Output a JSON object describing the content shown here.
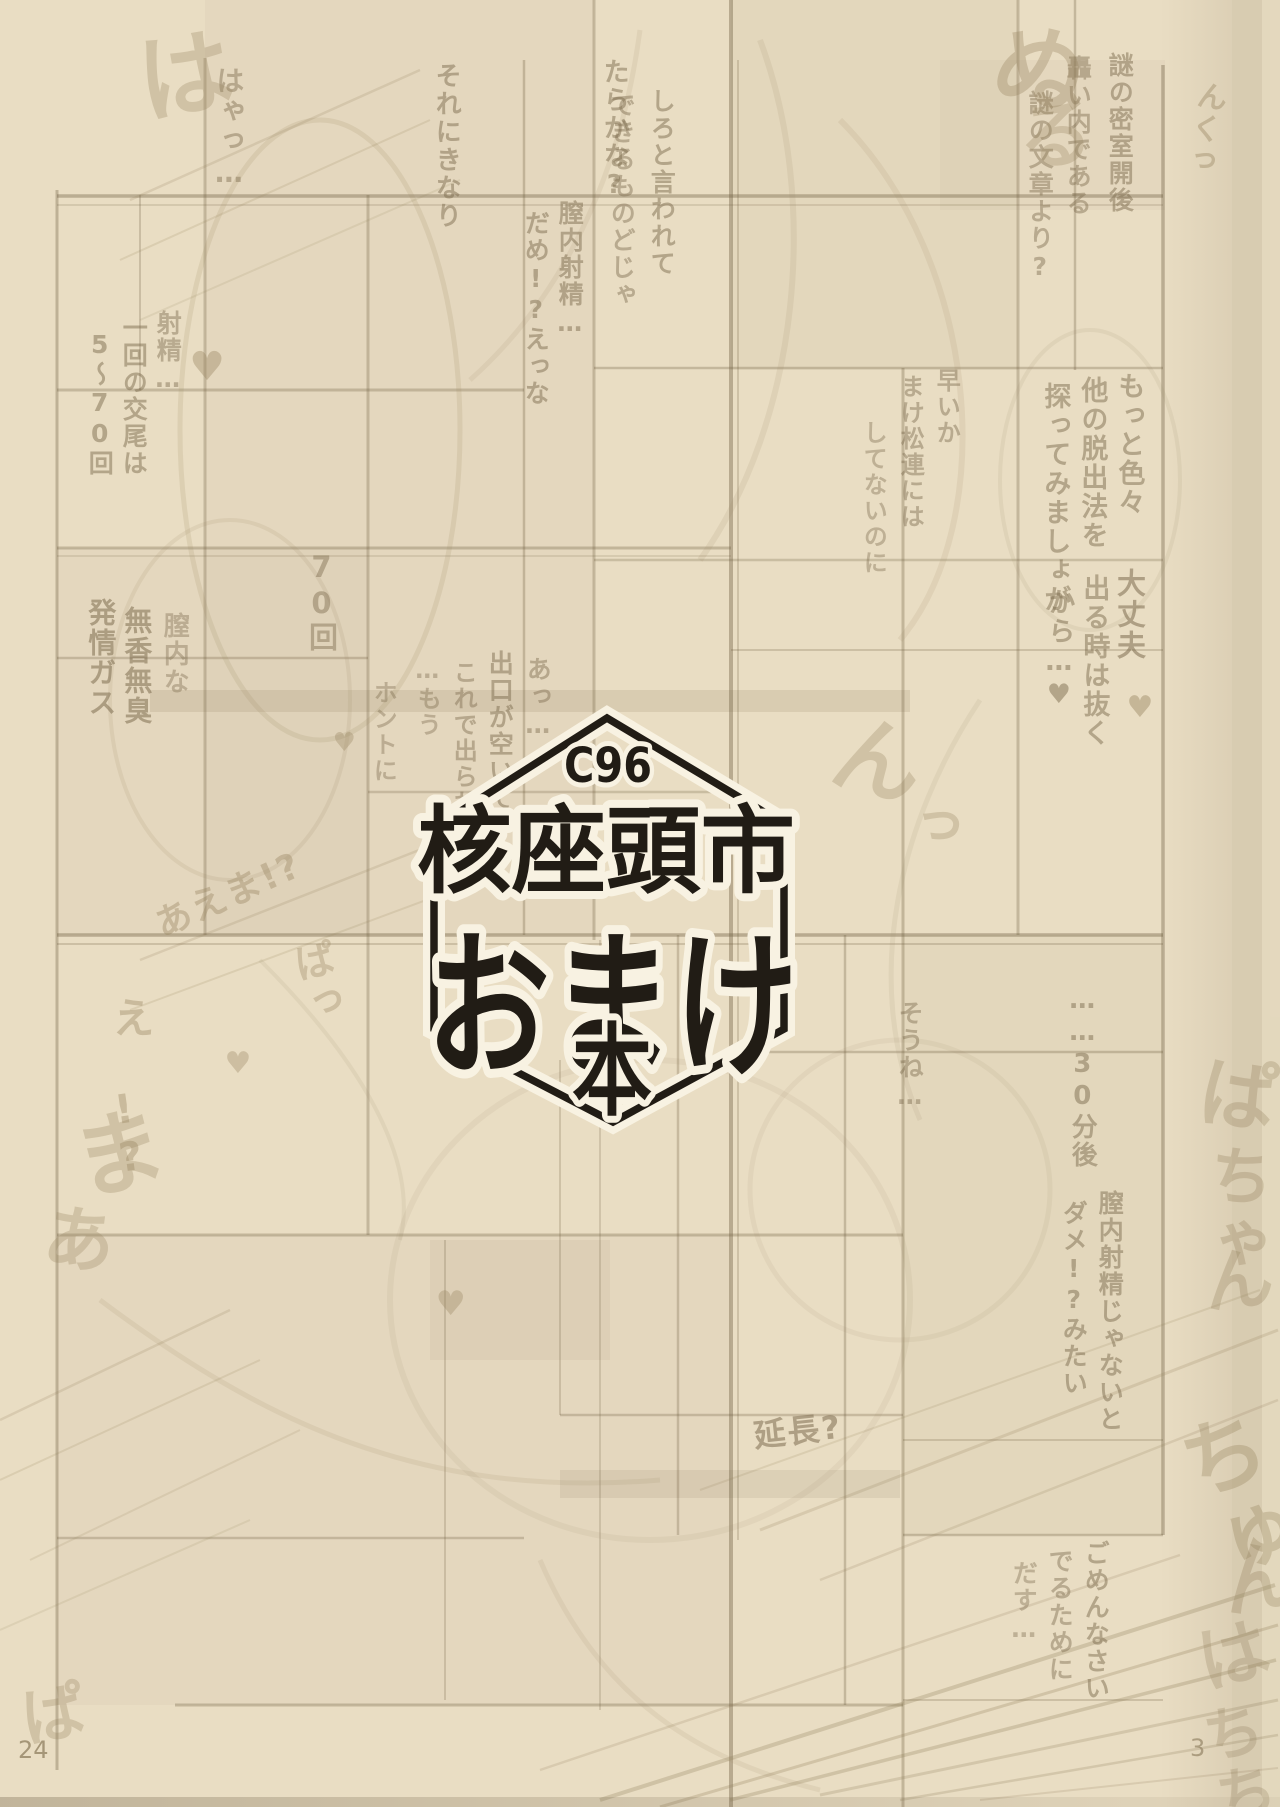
{
  "page": {
    "left_page_number": "24",
    "right_page_number": "3"
  },
  "logo": {
    "event_code": "C96",
    "title_kanji": "核座頭市",
    "title_kana": "おまけ",
    "title_suffix": "本"
  },
  "colors": {
    "paper": "#e9ddc3",
    "logo_ink": "#211c15",
    "logo_halo": "#f8f2e2",
    "bleed_ink": "#7f6e51",
    "sfx_ink": "#9a8763"
  },
  "bleedthrough": {
    "snippets": [
      {
        "text": "それにきなり",
        "x": 432,
        "y": 62,
        "size": 26,
        "o": 0.5
      },
      {
        "text": "たらかな?",
        "x": 600,
        "y": 58,
        "size": 26,
        "o": 0.5
      },
      {
        "text": "しろと言われて",
        "x": 648,
        "y": 88,
        "size": 25,
        "o": 0.5
      },
      {
        "text": "できるものどじゃ",
        "x": 608,
        "y": 92,
        "size": 25,
        "o": 0.45
      },
      {
        "text": "膣内射精…",
        "x": 556,
        "y": 200,
        "size": 25,
        "o": 0.5
      },
      {
        "text": "だめ!?えっな",
        "x": 522,
        "y": 210,
        "size": 25,
        "o": 0.5
      },
      {
        "text": "はゃっ…",
        "x": 214,
        "y": 66,
        "size": 28,
        "o": 0.45
      },
      {
        "text": "謎の密室開後",
        "x": 1106,
        "y": 52,
        "size": 25,
        "o": 0.5
      },
      {
        "text": "轟い内である",
        "x": 1064,
        "y": 55,
        "size": 25,
        "o": 0.45
      },
      {
        "text": "謎の文章より?",
        "x": 1026,
        "y": 90,
        "size": 25,
        "o": 0.45
      },
      {
        "text": "もっと色々",
        "x": 1114,
        "y": 372,
        "size": 27,
        "o": 0.5
      },
      {
        "text": "他の脱出法を",
        "x": 1077,
        "y": 376,
        "size": 27,
        "o": 0.5
      },
      {
        "text": "探ってみましょが",
        "x": 1040,
        "y": 382,
        "size": 27,
        "o": 0.5
      },
      {
        "text": "早いか",
        "x": 933,
        "y": 368,
        "size": 24,
        "o": 0.45
      },
      {
        "text": "まけ松連には",
        "x": 897,
        "y": 374,
        "size": 24,
        "o": 0.45
      },
      {
        "text": "してないのに",
        "x": 860,
        "y": 420,
        "size": 24,
        "o": 0.4
      },
      {
        "text": "大丈夫",
        "x": 1114,
        "y": 568,
        "size": 29,
        "o": 0.55
      },
      {
        "text": "出る時は抜く",
        "x": 1079,
        "y": 574,
        "size": 27,
        "o": 0.5
      },
      {
        "text": "から…♥",
        "x": 1044,
        "y": 588,
        "size": 27,
        "o": 0.5
      },
      {
        "text": "あっ…",
        "x": 524,
        "y": 656,
        "size": 25,
        "o": 0.45
      },
      {
        "text": "出口が空いて",
        "x": 486,
        "y": 650,
        "size": 25,
        "o": 0.5
      },
      {
        "text": "これで出られ",
        "x": 450,
        "y": 660,
        "size": 24,
        "o": 0.45
      },
      {
        "text": "…もう",
        "x": 414,
        "y": 656,
        "size": 24,
        "o": 0.4
      },
      {
        "text": "ホントに",
        "x": 370,
        "y": 680,
        "size": 24,
        "o": 0.4
      },
      {
        "text": "一回の交尾は",
        "x": 120,
        "y": 315,
        "size": 25,
        "o": 0.5
      },
      {
        "text": "5〜70回",
        "x": 86,
        "y": 330,
        "size": 25,
        "o": 0.5
      },
      {
        "text": "射精…",
        "x": 154,
        "y": 310,
        "size": 25,
        "o": 0.45
      },
      {
        "text": "70回",
        "x": 306,
        "y": 550,
        "size": 29,
        "o": 0.45
      },
      {
        "text": "発情ガス",
        "x": 86,
        "y": 598,
        "size": 28,
        "o": 0.55
      },
      {
        "text": "無香無臭",
        "x": 122,
        "y": 606,
        "size": 28,
        "o": 0.55
      },
      {
        "text": "膣内な",
        "x": 160,
        "y": 612,
        "size": 26,
        "o": 0.4
      },
      {
        "text": "そうね…",
        "x": 896,
        "y": 1000,
        "size": 25,
        "o": 0.45
      },
      {
        "text": "……30分後",
        "x": 1068,
        "y": 985,
        "size": 26,
        "o": 0.5
      },
      {
        "text": "膣内射精じゃないと",
        "x": 1096,
        "y": 1190,
        "size": 25,
        "o": 0.5
      },
      {
        "text": "ダメ!?みたい",
        "x": 1060,
        "y": 1200,
        "size": 25,
        "o": 0.5
      },
      {
        "text": "ごめんなさい",
        "x": 1082,
        "y": 1540,
        "size": 25,
        "o": 0.5
      },
      {
        "text": "でるために",
        "x": 1046,
        "y": 1548,
        "size": 25,
        "o": 0.45
      },
      {
        "text": "だす…",
        "x": 1010,
        "y": 1560,
        "size": 25,
        "o": 0.4
      },
      {
        "text": "延長?",
        "x": 752,
        "y": 1420,
        "size": 32,
        "rot": -6,
        "o": 0.55,
        "dir": "h"
      }
    ],
    "sfx": [
      {
        "text": "ぬ",
        "x": 994,
        "y": 8,
        "size": 95,
        "rot": 12,
        "o": 0.35
      },
      {
        "text": "る",
        "x": 1006,
        "y": 100,
        "size": 75,
        "rot": -5,
        "o": 0.3
      },
      {
        "text": "んくっ",
        "x": 1196,
        "y": 78,
        "size": 30,
        "rot": 10,
        "o": 0.4
      },
      {
        "text": "は",
        "x": 118,
        "y": 36,
        "size": 96,
        "rot": -10,
        "o": 0.3
      },
      {
        "text": "ん",
        "x": 836,
        "y": 700,
        "size": 90,
        "rot": 15,
        "o": 0.3
      },
      {
        "text": "っ",
        "x": 905,
        "y": 790,
        "size": 55,
        "rot": 10,
        "o": 0.3
      },
      {
        "text": "あえま!?",
        "x": 150,
        "y": 910,
        "size": 36,
        "rot": -24,
        "o": 0.4,
        "dir": "h"
      },
      {
        "text": "ぱっ",
        "x": 286,
        "y": 946,
        "size": 40,
        "rot": -12,
        "o": 0.35
      },
      {
        "text": "え",
        "x": 108,
        "y": 996,
        "size": 42,
        "o": 0.4
      },
      {
        "text": "!?",
        "x": 100,
        "y": 1090,
        "size": 40,
        "rot": -8,
        "o": 0.4
      },
      {
        "text": "ま",
        "x": 52,
        "y": 1120,
        "size": 92,
        "rot": -14,
        "o": 0.3
      },
      {
        "text": "あ",
        "x": 40,
        "y": 1196,
        "size": 72,
        "rot": 8,
        "o": 0.3
      },
      {
        "text": "ぱ",
        "x": 1196,
        "y": 1048,
        "size": 78,
        "rot": 8,
        "o": 0.3
      },
      {
        "text": "ちゃ",
        "x": 1204,
        "y": 1140,
        "size": 64,
        "rot": 5,
        "o": 0.3
      },
      {
        "text": "ん",
        "x": 1192,
        "y": 1248,
        "size": 70,
        "rot": -6,
        "o": 0.3
      },
      {
        "text": "ちゅ",
        "x": 1160,
        "y": 1430,
        "size": 85,
        "rot": -18,
        "o": 0.32
      },
      {
        "text": "ん",
        "x": 1205,
        "y": 1545,
        "size": 80,
        "rot": -10,
        "o": 0.3
      },
      {
        "text": "は",
        "x": 1180,
        "y": 1630,
        "size": 72,
        "rot": -15,
        "o": 0.28
      },
      {
        "text": "ちち",
        "x": 1190,
        "y": 1710,
        "size": 60,
        "rot": -12,
        "o": 0.28
      },
      {
        "text": "ぱ",
        "x": 8,
        "y": 1688,
        "size": 64,
        "rot": -10,
        "o": 0.3
      },
      {
        "text": "♥",
        "x": 186,
        "y": 344,
        "size": 40,
        "o": 0.4
      },
      {
        "text": "♥",
        "x": 1124,
        "y": 690,
        "size": 30,
        "o": 0.45
      },
      {
        "text": "♥",
        "x": 330,
        "y": 728,
        "size": 26,
        "o": 0.35
      },
      {
        "text": "♥",
        "x": 432,
        "y": 1284,
        "size": 34,
        "o": 0.35
      },
      {
        "text": "♥",
        "x": 222,
        "y": 1046,
        "size": 30,
        "o": 0.35
      }
    ]
  }
}
